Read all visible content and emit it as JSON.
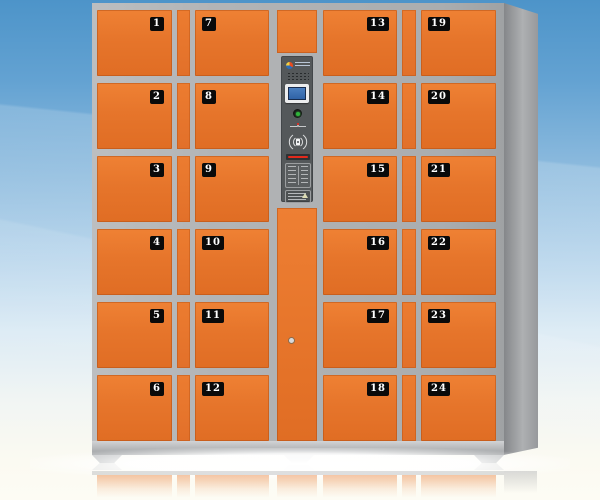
{
  "product": {
    "background": {
      "sky_top_color": "#4d94c9",
      "sky_bottom_color": "#fdfcf4"
    },
    "lockers": {
      "door_color": "#e6752b",
      "frame_color": "#b3b5b7",
      "badge_background": "#0a0a0a",
      "badge_text_color": "#ffffff",
      "columns": [
        {
          "badge_side": "right",
          "doors": [
            "1",
            "2",
            "3",
            "4",
            "5",
            "6"
          ]
        },
        {
          "badge_side": "left",
          "doors": [
            "7",
            "8",
            "9",
            "10",
            "11",
            "12"
          ]
        },
        {
          "badge_side": "right",
          "doors": [
            "13",
            "14",
            "15",
            "16",
            "17",
            "18"
          ]
        },
        {
          "badge_side": "left",
          "doors": [
            "19",
            "20",
            "21",
            "22",
            "23",
            "24"
          ]
        }
      ]
    },
    "control_panel": {
      "panel_color": "#54585a",
      "screen_color": "#3468ad",
      "button_color": "#2fb43a",
      "card_slot_color": "#e22a1c",
      "icons": [
        "brand-logo-icon",
        "speaker-grille-icon",
        "lcd-screen",
        "confirm-button",
        "keyhole-icon",
        "rfid-reader-icon",
        "card-slot",
        "instruction-label",
        "spec-label"
      ]
    }
  }
}
